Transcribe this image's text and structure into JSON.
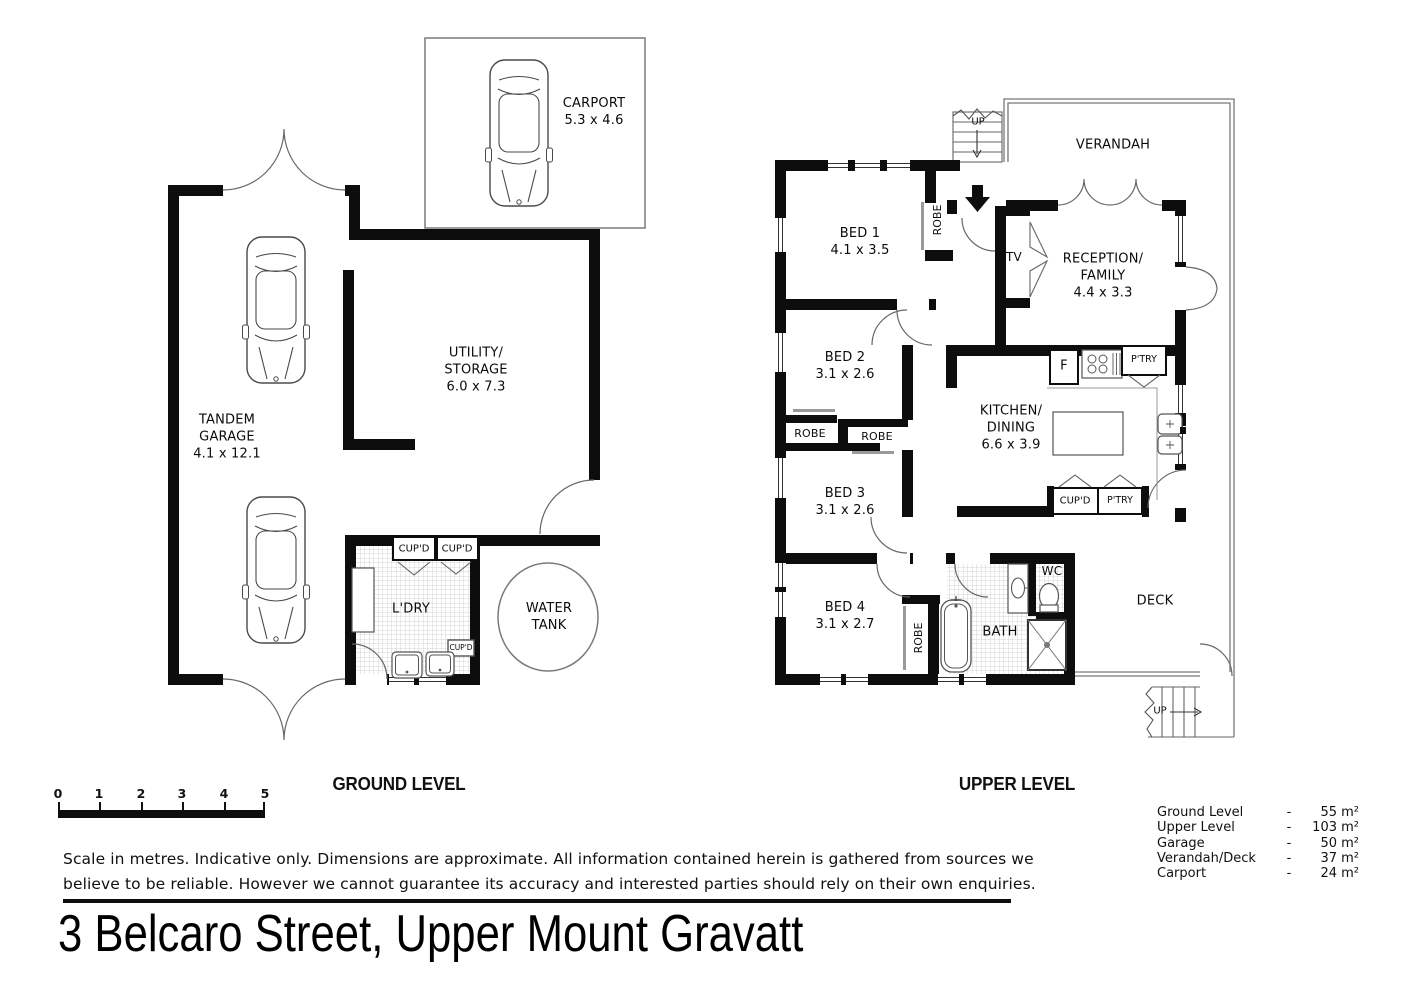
{
  "title": "3 Belcaro Street, Upper Mount Gravatt",
  "ground": {
    "level_label": "GROUND LEVEL",
    "rooms": {
      "carport": "CARPORT\n5.3 x 4.6",
      "tandem_garage": "TANDEM\nGARAGE\n4.1 x 12.1",
      "utility": "UTILITY/\nSTORAGE\n6.0 x 7.3",
      "laundry": "L'DRY",
      "water_tank": "WATER\nTANK",
      "cupboard_left": "CUP'D",
      "cupboard_right": "CUP'D",
      "cupboard_small": "CUP'D"
    }
  },
  "upper": {
    "level_label": "UPPER LEVEL",
    "rooms": {
      "verandah": "VERANDAH",
      "stairs_top": "UP",
      "stairs_bottom": "UP",
      "bed1": "BED 1\n4.1 x 3.5",
      "bed2": "BED 2\n3.1 x 2.6",
      "bed3": "BED 3\n3.1 x 2.6",
      "bed4": "BED 4\n3.1 x 2.7",
      "reception": "RECEPTION/\nFAMILY\n4.4 x 3.3",
      "kitchen": "KITCHEN/\nDINING\n6.6 x 3.9",
      "bath": "BATH",
      "wc": "WC",
      "deck": "DECK",
      "tv": "TV",
      "fridge": "F",
      "robe_bed1": "ROBE",
      "robe_bed2": "ROBE",
      "robe_bed3": "ROBE",
      "robe_bed4": "ROBE",
      "pantry_top": "P'TRY",
      "pantry_bottom": "P'TRY",
      "cupboard": "CUP'D"
    }
  },
  "scale_bar": {
    "ticks": [
      "0",
      "1",
      "2",
      "3",
      "4",
      "5"
    ]
  },
  "areas": {
    "separator": "-",
    "rows": [
      {
        "label": "Ground Level",
        "value": "55 m²"
      },
      {
        "label": "Upper Level",
        "value": "103 m²"
      },
      {
        "label": "Garage",
        "value": "50 m²"
      },
      {
        "label": "Verandah/Deck",
        "value": "37 m²"
      },
      {
        "label": "Carport",
        "value": "24 m²"
      }
    ]
  },
  "footer": {
    "disclaimer": "Scale in metres. Indicative only. Dimensions are approximate.  All information contained herein is gathered from sources we\nbelieve to be reliable. However we cannot guarantee its accuracy and interested parties should rely on their own enquiries."
  }
}
